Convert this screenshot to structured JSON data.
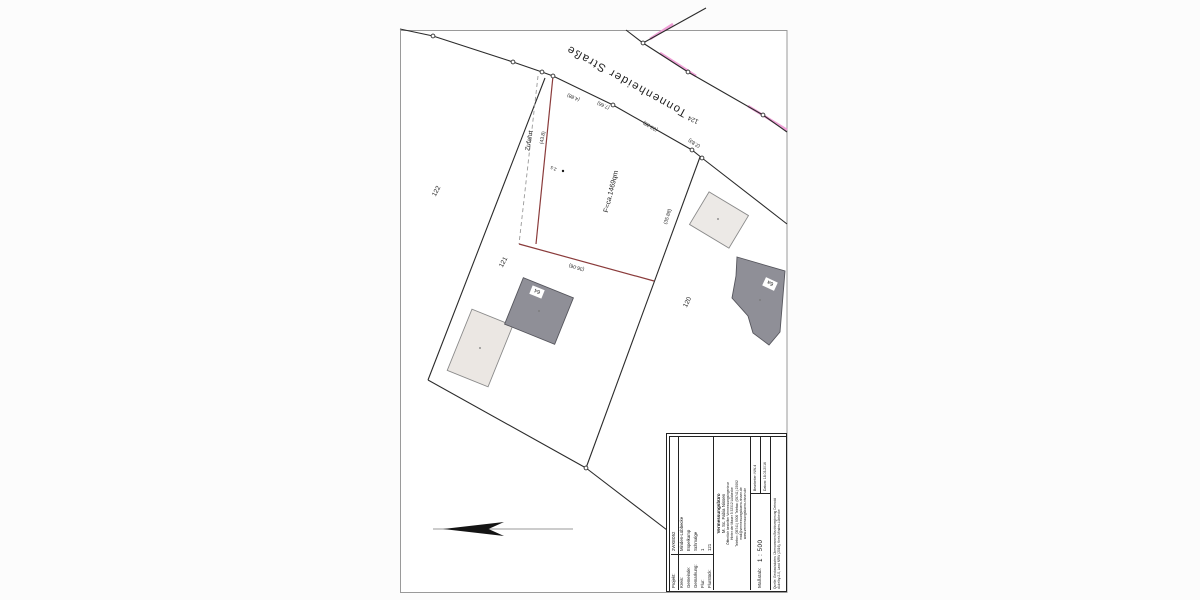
{
  "map": {
    "street_label": "Tonnenheider Straße",
    "area_label": "F=ca.1469qm",
    "zufahrt_label": "Zufahrt",
    "width_marker": "2.5",
    "parcels": {
      "p122": "122",
      "p121": "121",
      "p120": "120",
      "p124": "124"
    },
    "measurements": {
      "seg1": "(4.88)",
      "seg2": "(7.66)",
      "seg3": "(23.28)",
      "seg4": "(2.83)",
      "zufahrt_len": "(43.8)",
      "east_len": "(35.88)",
      "south_len": "(36.06)"
    },
    "houses": {
      "h64": "64",
      "h6a": "6a"
    },
    "colors": {
      "boundary": "#2b2b2b",
      "boundary_new": "#8a3b3b",
      "highlight_pink": "#efa0d6",
      "building_dark": "#8f8f97",
      "building_light": "#ebe7e3"
    }
  },
  "title_block": {
    "rows": [
      {
        "label": "Projekt:",
        "value": "2WKE052"
      },
      {
        "label": "Kreis:",
        "value": "Minden-Lübbecke"
      },
      {
        "label": "Gemeinde:",
        "value": "Espelkamp"
      },
      {
        "label": "Gemarkung:",
        "value": "Schmalge"
      },
      {
        "label": "Flur:",
        "value": "1"
      },
      {
        "label": "Flurstück:",
        "value": "121"
      }
    ],
    "office": {
      "line1": "Vermessungsbüro",
      "line2": "M. Sc. Fabia Nissen",
      "line3": "Öffentlich bestellter Vermessungsingenieur",
      "line4": "Hinter der Mauer 5   32312 Lübbecke",
      "line5": "Telefon: (05741) 9300   Telefax: (05741) 23092",
      "line6": "mail@vermessungsbuero-nissen.de",
      "line7": "www.vermessungsbuero-nissen.de"
    },
    "scale_label": "Maßstab:",
    "scale_value": "1 : 500",
    "editor": "Bearbeiter: NW-4",
    "date": "Datum: 18.03.2016",
    "source_line1": "Quelle: Geobasisdaten: Übernommen Bezirksregierung Detmold",
    "source_line2": "dl-de/by-2-0, Land NRW (2016), Kreis Minden-Lübbecke"
  }
}
